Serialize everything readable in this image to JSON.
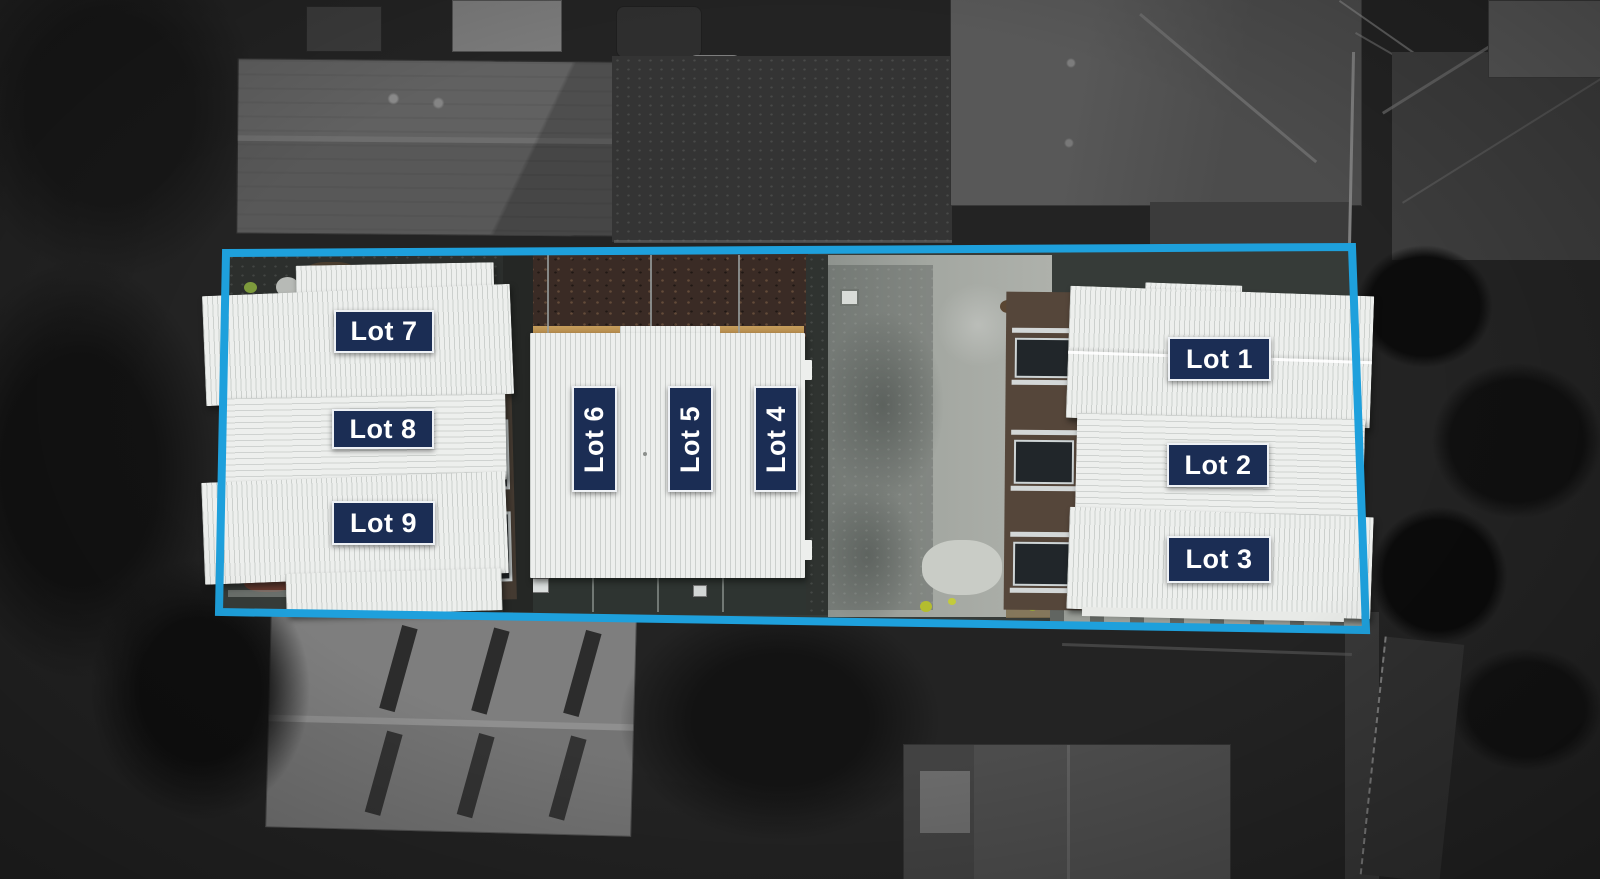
{
  "site_plan": {
    "boundary": {
      "color": "#1ea0dc"
    },
    "label_style": {
      "background": "#1b2d54",
      "text_color": "#ffffff",
      "border_color": "#eef1f5"
    },
    "lots": [
      {
        "label": "Lot 1",
        "orientation": "horizontal"
      },
      {
        "label": "Lot 2",
        "orientation": "horizontal"
      },
      {
        "label": "Lot 3",
        "orientation": "horizontal"
      },
      {
        "label": "Lot 4",
        "orientation": "vertical"
      },
      {
        "label": "Lot 5",
        "orientation": "vertical"
      },
      {
        "label": "Lot 6",
        "orientation": "vertical"
      },
      {
        "label": "Lot 7",
        "orientation": "horizontal"
      },
      {
        "label": "Lot 8",
        "orientation": "horizontal"
      },
      {
        "label": "Lot 9",
        "orientation": "horizontal"
      }
    ],
    "palette": {
      "roof_white": "#edefed",
      "concrete_gray": "#a3a7a1",
      "surroundings_dark": "#232323"
    }
  }
}
